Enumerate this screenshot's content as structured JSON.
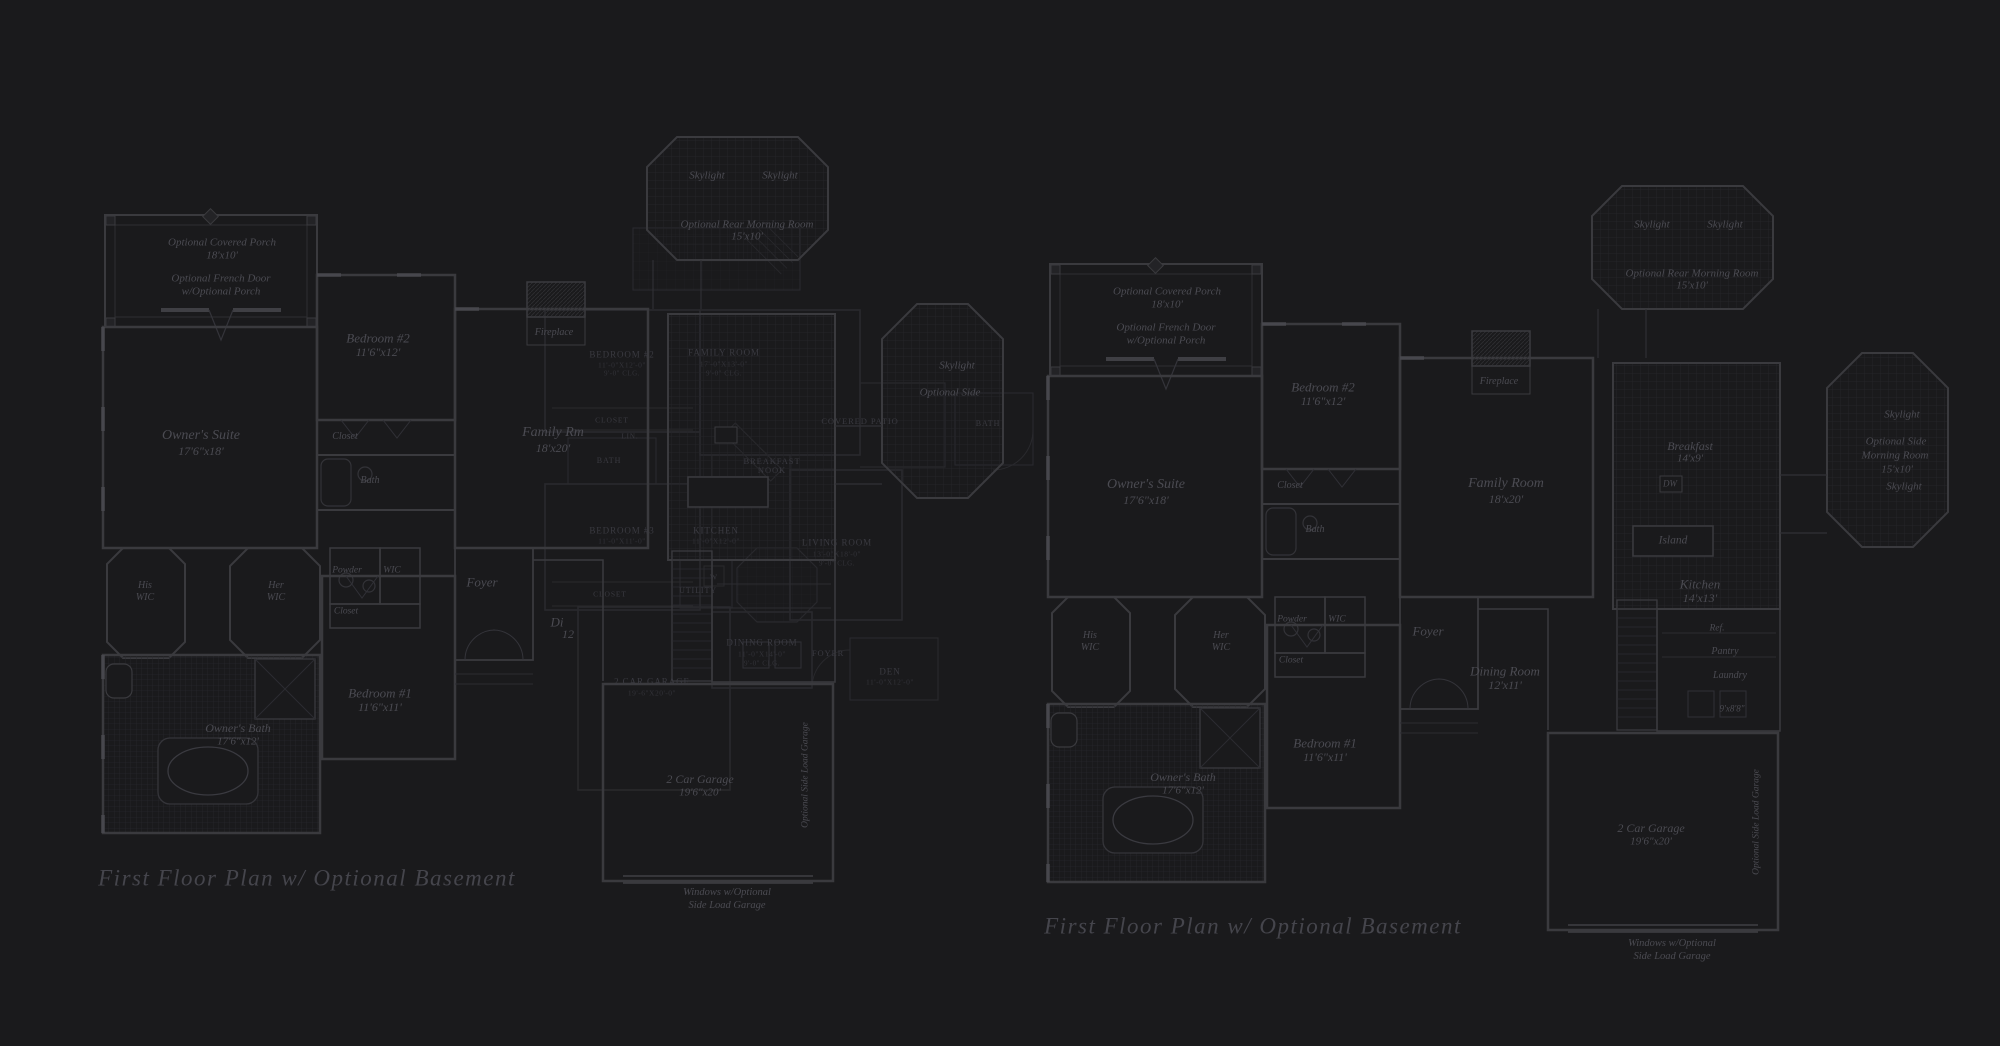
{
  "page": {
    "background": "#1a1a1c",
    "line_color": "#3a3a3e",
    "overlay_line_color": "#2b2b2f",
    "text_color": "#4b4b52",
    "title_color": "#45454c"
  },
  "titles": {
    "left": "First Floor Plan  w/ Optional Basement",
    "right": "First Floor Plan  w/ Optional Basement"
  },
  "left_plan": {
    "labels": [
      {
        "name": "porch-label",
        "text": "Optional Covered Porch",
        "x": 222,
        "y": 243,
        "size": 11
      },
      {
        "name": "porch-dim",
        "text": "18'x10'",
        "x": 222,
        "y": 256,
        "size": 11
      },
      {
        "name": "french-door-label",
        "text": "Optional French Door",
        "x": 221,
        "y": 279,
        "size": 11
      },
      {
        "name": "french-door-label-2",
        "text": "w/Optional Porch",
        "x": 221,
        "y": 292,
        "size": 11
      },
      {
        "name": "owners-suite-label",
        "text": "Owner's Suite",
        "x": 201,
        "y": 436,
        "size": 14
      },
      {
        "name": "owners-suite-dim",
        "text": "17'6\"x18'",
        "x": 201,
        "y": 451,
        "size": 12
      },
      {
        "name": "bedroom2-label",
        "text": "Bedroom #2",
        "x": 378,
        "y": 338,
        "size": 13
      },
      {
        "name": "bedroom2-dim",
        "text": "11'6\"x12'",
        "x": 378,
        "y": 352,
        "size": 12
      },
      {
        "name": "closet-bedroom2-label",
        "text": "Closet",
        "x": 345,
        "y": 437,
        "size": 10
      },
      {
        "name": "bath-label",
        "text": "Bath",
        "x": 370,
        "y": 481,
        "size": 10
      },
      {
        "name": "fireplace-label",
        "text": "Fireplace",
        "x": 554,
        "y": 333,
        "size": 10
      },
      {
        "name": "family-room-label",
        "text": "Family Rm",
        "x": 553,
        "y": 433,
        "size": 14
      },
      {
        "name": "family-room-dim",
        "text": "18'x20'",
        "x": 553,
        "y": 448,
        "size": 12
      },
      {
        "name": "skylight-a-label",
        "text": "Skylight",
        "x": 707,
        "y": 176,
        "size": 11
      },
      {
        "name": "skylight-b-label",
        "text": "Skylight",
        "x": 780,
        "y": 176,
        "size": 11
      },
      {
        "name": "rear-morning-room-label",
        "text": "Optional Rear Morning Room",
        "x": 747,
        "y": 225,
        "size": 11
      },
      {
        "name": "rear-morning-room-dim",
        "text": "15'x10'",
        "x": 747,
        "y": 237,
        "size": 11
      },
      {
        "name": "side-skylight-label",
        "text": "Skylight",
        "x": 957,
        "y": 366,
        "size": 11
      },
      {
        "name": "side-morning-room-label",
        "text": "Optional Side",
        "x": 950,
        "y": 393,
        "size": 11
      },
      {
        "name": "his-wic-label",
        "text": "His",
        "x": 145,
        "y": 586,
        "size": 10
      },
      {
        "name": "his-wic-label-2",
        "text": "WIC",
        "x": 145,
        "y": 598,
        "size": 10
      },
      {
        "name": "her-wic-label",
        "text": "Her",
        "x": 276,
        "y": 586,
        "size": 10
      },
      {
        "name": "her-wic-label-2",
        "text": "WIC",
        "x": 276,
        "y": 598,
        "size": 10
      },
      {
        "name": "powder-label",
        "text": "Powder",
        "x": 347,
        "y": 571,
        "size": 9.5
      },
      {
        "name": "wic-label",
        "text": "WIC",
        "x": 392,
        "y": 571,
        "size": 9.5
      },
      {
        "name": "closet-hall-label",
        "text": "Closet",
        "x": 346,
        "y": 612,
        "size": 9.5
      },
      {
        "name": "foyer-label",
        "text": "Foyer",
        "x": 482,
        "y": 582,
        "size": 13
      },
      {
        "name": "dining-label-partial",
        "text": "Di",
        "x": 557,
        "y": 622,
        "size": 13
      },
      {
        "name": "dining-dim-partial",
        "text": "12",
        "x": 568,
        "y": 634,
        "size": 12
      },
      {
        "name": "bedroom1-label",
        "text": "Bedroom #1",
        "x": 380,
        "y": 693,
        "size": 13
      },
      {
        "name": "bedroom1-dim",
        "text": "11'6\"x11'",
        "x": 380,
        "y": 707,
        "size": 12
      },
      {
        "name": "owners-bath-label",
        "text": "Owner's Bath",
        "x": 238,
        "y": 728,
        "size": 12
      },
      {
        "name": "owners-bath-dim",
        "text": "17'6\"x12'",
        "x": 238,
        "y": 742,
        "size": 11
      },
      {
        "name": "garage-label",
        "text": "2 Car Garage",
        "x": 700,
        "y": 779,
        "size": 12
      },
      {
        "name": "garage-dim",
        "text": "19'6\"x20'",
        "x": 700,
        "y": 793,
        "size": 11
      },
      {
        "name": "side-load-garage-label",
        "text": "Optional Side Load Garage",
        "x": 806,
        "y": 775,
        "size": 9.5,
        "rot": true
      },
      {
        "name": "windows-note-label",
        "text": "Windows w/Optional",
        "x": 727,
        "y": 893,
        "size": 10.5
      },
      {
        "name": "windows-note-label-2",
        "text": "Side Load Garage",
        "x": 727,
        "y": 906,
        "size": 10.5
      }
    ]
  },
  "right_plan": {
    "labels": [
      {
        "name": "porch-label",
        "text": "Optional Covered Porch",
        "x": 1167,
        "y": 292,
        "size": 11
      },
      {
        "name": "porch-dim",
        "text": "18'x10'",
        "x": 1167,
        "y": 305,
        "size": 11
      },
      {
        "name": "french-door-label",
        "text": "Optional French Door",
        "x": 1166,
        "y": 328,
        "size": 11
      },
      {
        "name": "french-door-label-2",
        "text": "w/Optional Porch",
        "x": 1166,
        "y": 341,
        "size": 11
      },
      {
        "name": "owners-suite-label",
        "text": "Owner's Suite",
        "x": 1146,
        "y": 485,
        "size": 14
      },
      {
        "name": "owners-suite-dim",
        "text": "17'6\"x18'",
        "x": 1146,
        "y": 500,
        "size": 12
      },
      {
        "name": "bedroom2-label",
        "text": "Bedroom #2",
        "x": 1323,
        "y": 387,
        "size": 13
      },
      {
        "name": "bedroom2-dim",
        "text": "11'6\"x12'",
        "x": 1323,
        "y": 401,
        "size": 12
      },
      {
        "name": "closet-bedroom2-label",
        "text": "Closet",
        "x": 1290,
        "y": 486,
        "size": 10
      },
      {
        "name": "bath-label",
        "text": "Bath",
        "x": 1315,
        "y": 530,
        "size": 10
      },
      {
        "name": "fireplace-label",
        "text": "Fireplace",
        "x": 1499,
        "y": 382,
        "size": 10
      },
      {
        "name": "family-room-label",
        "text": "Family Room",
        "x": 1506,
        "y": 484,
        "size": 14
      },
      {
        "name": "family-room-dim",
        "text": "18'x20'",
        "x": 1506,
        "y": 499,
        "size": 12
      },
      {
        "name": "skylight-a-label",
        "text": "Skylight",
        "x": 1652,
        "y": 225,
        "size": 11
      },
      {
        "name": "skylight-b-label",
        "text": "Skylight",
        "x": 1725,
        "y": 225,
        "size": 11
      },
      {
        "name": "rear-morning-room-label",
        "text": "Optional Rear Morning Room",
        "x": 1692,
        "y": 274,
        "size": 11
      },
      {
        "name": "rear-morning-room-dim",
        "text": "15'x10'",
        "x": 1692,
        "y": 286,
        "size": 11
      },
      {
        "name": "side-skylight-label",
        "text": "Skylight",
        "x": 1902,
        "y": 415,
        "size": 11
      },
      {
        "name": "side-morning-room-label",
        "text": "Optional Side",
        "x": 1896,
        "y": 442,
        "size": 11
      },
      {
        "name": "side-morning-room-label-2",
        "text": "Morning Room",
        "x": 1895,
        "y": 456,
        "size": 11
      },
      {
        "name": "side-morning-room-dim",
        "text": "15'x10'",
        "x": 1897,
        "y": 470,
        "size": 11
      },
      {
        "name": "side-skylight-b-label",
        "text": "Skylight",
        "x": 1904,
        "y": 487,
        "size": 11
      },
      {
        "name": "breakfast-label",
        "text": "Breakfast",
        "x": 1690,
        "y": 446,
        "size": 12
      },
      {
        "name": "breakfast-dim",
        "text": "14'x9'",
        "x": 1690,
        "y": 459,
        "size": 11
      },
      {
        "name": "dw-label",
        "text": "DW",
        "x": 1670,
        "y": 484,
        "size": 9
      },
      {
        "name": "island-label",
        "text": "Island",
        "x": 1673,
        "y": 541,
        "size": 11.5
      },
      {
        "name": "kitchen-label",
        "text": "Kitchen",
        "x": 1700,
        "y": 584,
        "size": 13
      },
      {
        "name": "kitchen-dim",
        "text": "14'x13'",
        "x": 1700,
        "y": 598,
        "size": 12
      },
      {
        "name": "ref-label",
        "text": "Ref.",
        "x": 1717,
        "y": 629,
        "size": 9.5
      },
      {
        "name": "pantry-label",
        "text": "Pantry",
        "x": 1725,
        "y": 652,
        "size": 10
      },
      {
        "name": "laundry-label",
        "text": "Laundry",
        "x": 1730,
        "y": 676,
        "size": 10
      },
      {
        "name": "laundry-dim",
        "text": "9'x8'8\"",
        "x": 1732,
        "y": 709,
        "size": 9
      },
      {
        "name": "his-wic-label",
        "text": "His",
        "x": 1090,
        "y": 636,
        "size": 10
      },
      {
        "name": "his-wic-label-2",
        "text": "WIC",
        "x": 1090,
        "y": 648,
        "size": 10
      },
      {
        "name": "her-wic-label",
        "text": "Her",
        "x": 1221,
        "y": 636,
        "size": 10
      },
      {
        "name": "her-wic-label-2",
        "text": "WIC",
        "x": 1221,
        "y": 648,
        "size": 10
      },
      {
        "name": "powder-label",
        "text": "Powder",
        "x": 1292,
        "y": 620,
        "size": 9.5
      },
      {
        "name": "wic-label",
        "text": "WIC",
        "x": 1337,
        "y": 620,
        "size": 9.5
      },
      {
        "name": "closet-hall-label",
        "text": "Closet",
        "x": 1291,
        "y": 661,
        "size": 9.5
      },
      {
        "name": "foyer-label",
        "text": "Foyer",
        "x": 1428,
        "y": 631,
        "size": 13
      },
      {
        "name": "dining-label",
        "text": "Dining Room",
        "x": 1505,
        "y": 671,
        "size": 13
      },
      {
        "name": "dining-dim",
        "text": "12'x11'",
        "x": 1505,
        "y": 685,
        "size": 12
      },
      {
        "name": "bedroom1-label",
        "text": "Bedroom #1",
        "x": 1325,
        "y": 743,
        "size": 13
      },
      {
        "name": "bedroom1-dim",
        "text": "11'6\"x11'",
        "x": 1325,
        "y": 757,
        "size": 12
      },
      {
        "name": "owners-bath-label",
        "text": "Owner's Bath",
        "x": 1183,
        "y": 777,
        "size": 12
      },
      {
        "name": "owners-bath-dim",
        "text": "17'6\"x12'",
        "x": 1183,
        "y": 791,
        "size": 11
      },
      {
        "name": "garage-label",
        "text": "2 Car Garage",
        "x": 1651,
        "y": 828,
        "size": 12
      },
      {
        "name": "garage-dim",
        "text": "19'6\"x20'",
        "x": 1651,
        "y": 842,
        "size": 11
      },
      {
        "name": "side-load-garage-label",
        "text": "Optional Side Load Garage",
        "x": 1757,
        "y": 822,
        "size": 9.5,
        "rot": true
      },
      {
        "name": "windows-note-label",
        "text": "Windows w/Optional",
        "x": 1672,
        "y": 944,
        "size": 10.5
      },
      {
        "name": "windows-note-label-2",
        "text": "Side Load Garage",
        "x": 1672,
        "y": 957,
        "size": 10.5
      }
    ]
  },
  "overlay_plan": {
    "labels": [
      {
        "name": "bedroom2-label",
        "text": "BEDROOM #2",
        "x": 622,
        "y": 355,
        "size": 9
      },
      {
        "name": "bedroom2-dim",
        "text": "11'-0\"X12'-0\"",
        "x": 622,
        "y": 365,
        "size": 7.5,
        "cls": "capsdim"
      },
      {
        "name": "bedroom2-clg",
        "text": "9'-0\" CLG.",
        "x": 622,
        "y": 374,
        "size": 7,
        "cls": "capsdim"
      },
      {
        "name": "family-room-label",
        "text": "FAMILY ROOM",
        "x": 724,
        "y": 353,
        "size": 9
      },
      {
        "name": "family-room-dim",
        "text": "17'-0\"X13'-0\"",
        "x": 724,
        "y": 364,
        "size": 7.5,
        "cls": "capsdim"
      },
      {
        "name": "family-room-clg",
        "text": "9'-0\" CLG.",
        "x": 724,
        "y": 374,
        "size": 7,
        "cls": "capsdim"
      },
      {
        "name": "closet-label",
        "text": "CLOSET",
        "x": 612,
        "y": 420,
        "size": 7.5
      },
      {
        "name": "linen-label",
        "text": "LIN.",
        "x": 630,
        "y": 437,
        "size": 7
      },
      {
        "name": "bath-label",
        "text": "BATH",
        "x": 609,
        "y": 461,
        "size": 8
      },
      {
        "name": "bedroom3-label",
        "text": "BEDROOM #3",
        "x": 622,
        "y": 531,
        "size": 9
      },
      {
        "name": "bedroom3-dim",
        "text": "11'-0\"X11'-0\"",
        "x": 622,
        "y": 541,
        "size": 7.5,
        "cls": "capsdim"
      },
      {
        "name": "kitchen-label",
        "text": "KITCHEN",
        "x": 716,
        "y": 531,
        "size": 9
      },
      {
        "name": "kitchen-dim",
        "text": "11'-0\"X12'-0\"",
        "x": 716,
        "y": 541,
        "size": 7.5,
        "cls": "capsdim"
      },
      {
        "name": "breakfast-label",
        "text": "BREAKFAST",
        "x": 772,
        "y": 461,
        "size": 8.5
      },
      {
        "name": "breakfast-label-2",
        "text": "NOOK",
        "x": 772,
        "y": 470,
        "size": 8.5
      },
      {
        "name": "covered-patio-label",
        "text": "COVERED PATIO",
        "x": 860,
        "y": 421,
        "size": 8.5
      },
      {
        "name": "living-room-label",
        "text": "LIVING ROOM",
        "x": 837,
        "y": 543,
        "size": 9
      },
      {
        "name": "living-room-dim",
        "text": "13'-0\"X18'-0\"",
        "x": 837,
        "y": 554,
        "size": 7.5,
        "cls": "capsdim"
      },
      {
        "name": "living-room-clg",
        "text": "9'-0\" CLG.",
        "x": 837,
        "y": 564,
        "size": 7,
        "cls": "capsdim"
      },
      {
        "name": "washer-label",
        "text": "W",
        "x": 714,
        "y": 577,
        "size": 7.5
      },
      {
        "name": "utility-label",
        "text": "UTILITY",
        "x": 698,
        "y": 591,
        "size": 8
      },
      {
        "name": "closet2-label",
        "text": "CLOSET",
        "x": 610,
        "y": 594,
        "size": 7.5
      },
      {
        "name": "dining-room-label",
        "text": "DINING ROOM",
        "x": 762,
        "y": 643,
        "size": 9
      },
      {
        "name": "dining-room-dim",
        "text": "11'-0\"X14'-0\"",
        "x": 762,
        "y": 654,
        "size": 7.5,
        "cls": "capsdim"
      },
      {
        "name": "dining-room-clg",
        "text": "9'-0\" CLG.",
        "x": 762,
        "y": 664,
        "size": 7,
        "cls": "capsdim"
      },
      {
        "name": "foyer-label",
        "text": "FOYER",
        "x": 828,
        "y": 653,
        "size": 8.5
      },
      {
        "name": "den-label",
        "text": "DEN",
        "x": 890,
        "y": 672,
        "size": 9
      },
      {
        "name": "den-dim",
        "text": "11'-0\"X12'-0\"",
        "x": 890,
        "y": 682,
        "size": 7.5,
        "cls": "capsdim"
      },
      {
        "name": "garage-label",
        "text": "2 CAR GARAGE",
        "x": 652,
        "y": 682,
        "size": 9
      },
      {
        "name": "garage-dim",
        "text": "19'-6\"X20'-0\"",
        "x": 652,
        "y": 693,
        "size": 7.5,
        "cls": "capsdim"
      },
      {
        "name": "bath2-label",
        "text": "BATH",
        "x": 988,
        "y": 424,
        "size": 8
      }
    ]
  }
}
